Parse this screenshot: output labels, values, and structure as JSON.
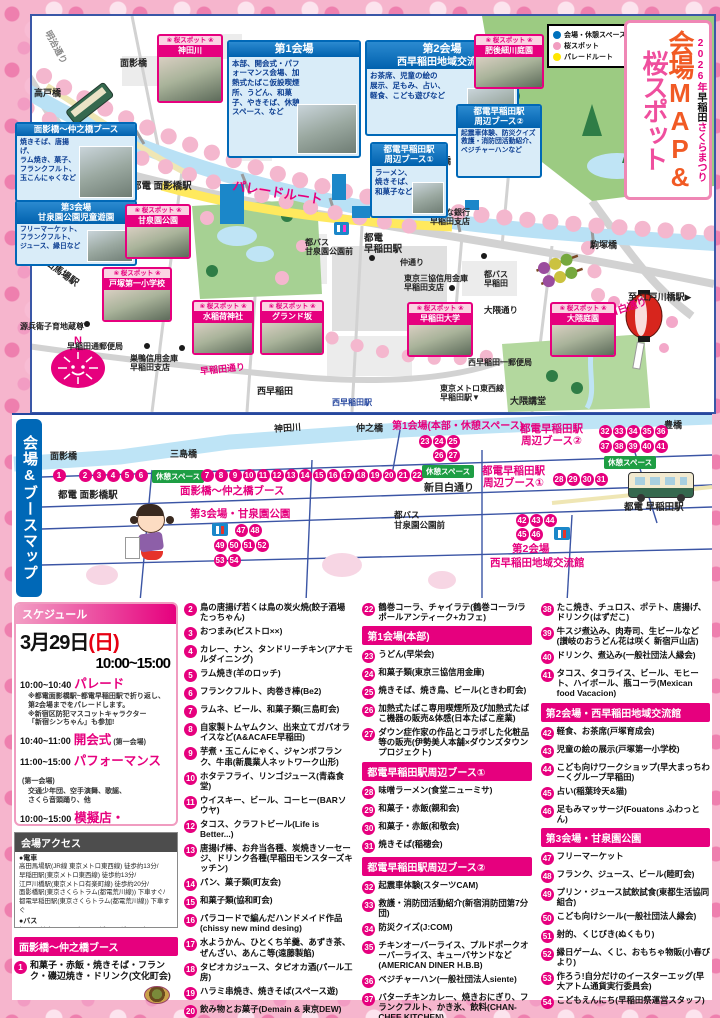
{
  "poster": {
    "title_sub_year": "2026年",
    "title_sub_mid": "早稲田",
    "title_sub_end": "さくらまつり",
    "title_main_1": "会場MAP&",
    "title_main_2": "桜スポット"
  },
  "colors": {
    "accent": "#e6007e",
    "venue_blue": "#0071bc",
    "sakura_pink": "#f19dc0",
    "parade_yellow": "#ffe600",
    "river": "#b9e1f5",
    "orange_title": "#f15a24"
  },
  "legend": {
    "items": [
      {
        "label": "会場・休憩スペース",
        "color": "#0071bc"
      },
      {
        "label": "桜スポット",
        "color": "#f19dc0"
      },
      {
        "label": "パレードルート",
        "color": "#ffe600"
      }
    ]
  },
  "map": {
    "labels": {
      "meiji_dori": "明治通り",
      "takato_bashi": "高戸橋",
      "omokage_bashi": "面影橋",
      "mishima_bashi": "三島橋",
      "nakano_bashi": "仲之橋",
      "toyo_bashi": "豊橋",
      "komatsuka_bashi": "駒塚橋",
      "toden_omokage_sta": "都電 面影橋駅",
      "parade_route": "パレードルート",
      "tobus_sensenen": "都バス\n甘泉園公園前",
      "toden_waseda_sta": "都電\n早稲田駅",
      "risona": "りそな銀行\n早稲田支店",
      "naka_dori": "仲通り",
      "sankyo_bank": "東京三協信用金庫\n早稲田支店",
      "nishiwaseda": "西早稲田",
      "nishiwaseda_sta": "西早稲田駅",
      "metro_waseda": "東京メトロ東西線\n早稲田駅▼",
      "okuma_dori": "大隈通り",
      "tobus_waseda": "都バス\n早稲田",
      "nishiwaseda_post": "西早稲田一郵便局",
      "okuma_auditorium": "大隈講堂",
      "edogawabashi": "至 江戸川橋駅▶",
      "shinmejiro_dori": "新目白通り",
      "takadanobaba": "◀至 高田馬場駅",
      "genbei_jizo": "源兵衛子育地蔵尊",
      "waseda_post": "早稲田通郵便局",
      "sugamo_bank": "巣鴨信用金庫\n早稲田支店",
      "waseda_dori": "早稲田通り"
    },
    "venues": [
      {
        "title": "第1会場",
        "body": "本部、開会式・パフォーマンス会場、加熱式たばこ仮設喫煙所、うどん、和菓子、やきそば、休憩スペース、など"
      },
      {
        "title": "第2会場",
        "title2": "西早稲田地域交流館",
        "body": "お茶席、児童の絵の\n展示、足もみ、占い、\n軽食、こども遊びなど"
      },
      {
        "title": "都電早稲田駅\n周辺ブース①",
        "body": "ラーメン、\n焼きそば、\n和菓子など"
      },
      {
        "title": "都電早稲田駅\n周辺ブース②",
        "body": "起震車体験、防災クイズ\n救護・消防団活動紹介、\nベジチャーハンなど"
      },
      {
        "title": "面影橋〜仲之橋ブース",
        "body": "焼きそば、唐揚げ、\nラム焼き、菓子、\nフランクフルト、\n玉こんにゃくなど"
      },
      {
        "title": "第3会場",
        "title2": "甘泉園公園児童遊園",
        "body": "フリーマーケット、\nフランクフルト、\nジュース、縁日など"
      }
    ],
    "spot_tag": "❀ 桜スポット ❀",
    "spots": [
      {
        "name": "神田川"
      },
      {
        "name": "肥後細川庭園"
      },
      {
        "name": "甘泉園公園"
      },
      {
        "name": "戸塚第一小学校"
      },
      {
        "name": "水稲荷神社"
      },
      {
        "name": "グランド坂"
      },
      {
        "name": "早稲田大学"
      },
      {
        "name": "大隈庭園"
      }
    ]
  },
  "booth_map": {
    "bar_label": "会場&ブースマップ",
    "labels": {
      "kandagawa": "神田川",
      "omokage": "面影橋",
      "mishima": "三島橋",
      "nakano": "仲之橋",
      "toyo": "豊橋",
      "toden_omokage": "都電 面影橋駅",
      "omokage_booth": "面影橋〜仲之橋ブース",
      "v3": "第3会場・甘泉園公園",
      "v1": "第1会場(本部・休憩スペース)",
      "b2": "都電早稲田駅\n周辺ブース②",
      "b1": "都電早稲田駅\n周辺ブース①",
      "shinmejiro": "新目白通り",
      "tobus": "都バス\n甘泉園公園前",
      "toden_waseda": "都電 早稲田駅",
      "v2a": "第2会場",
      "v2b": "西早稲田地域交流館",
      "rest": "休憩スペース"
    },
    "c1": [
      1
    ],
    "c2": [
      2,
      3,
      4,
      5,
      6
    ],
    "c3": [
      7,
      8,
      9,
      10,
      11,
      12,
      13,
      14,
      15,
      16,
      17,
      18,
      19,
      20,
      21,
      22
    ],
    "c4a": [
      23,
      24,
      25
    ],
    "c4b": [
      26,
      27
    ],
    "c5a": [
      32,
      33,
      34,
      35,
      36
    ],
    "c5b": [
      37,
      38,
      39,
      40,
      41
    ],
    "c6": [
      28,
      29,
      30,
      31
    ],
    "c7a": [
      42,
      43,
      44
    ],
    "c7b": [
      45,
      46
    ],
    "c8a": [
      47,
      48
    ],
    "c8b": [
      49,
      50,
      51,
      52
    ],
    "c8c": [
      53,
      54
    ]
  },
  "schedule": {
    "header": "スケジュール",
    "date": "3月29日",
    "date_sub": "(日)",
    "time": "10:00~15:00",
    "events": [
      {
        "time": "10:00~10:40",
        "name": "パレード",
        "sub": "",
        "notes": "※都電面影橋駅~都電早稲田駅で折り返し、\n第2会場までをパレードします。\n※新宿区防犯マスコットキャラクター\n「新宿シンちゃん」も参加!"
      },
      {
        "time": "10:40~11:00",
        "name": "開会式",
        "sub": "(第一会場)",
        "notes": ""
      },
      {
        "time": "11:00~15:00",
        "name": "パフォーマンス",
        "sub": "(第一会場)",
        "notes": "交通少年団、空手演舞、歌謡、\nさくら音頭踊り、他"
      },
      {
        "time": "10:00~15:00",
        "name": "模擬店・\nフリーマーケット",
        "sub": "※売り切れ御免",
        "notes": ""
      }
    ]
  },
  "access": {
    "header": "会場アクセス",
    "train_label": "●電車",
    "train": "高田馬場駅(JR線 東京メトロ東西線) 徒歩約13分/\n早稲田駅(東京メトロ東西線) 徒歩約13分/\n江戸川橋駅(東京メトロ有楽町線) 徒歩約20分/\n面影橋駅(東京さくらトラム(都電荒川線)) 下車すぐ/\n都電早稲田駅(東京さくらトラム(都電荒川線)) 下車すぐ",
    "bus_label": "●バス",
    "bus": "都バス 甘泉園公園/グランド坂下/早稲田 下車すぐ",
    "notes": "※ご来場は交通機関をご利用ください。\n※駐輪場はありません。"
  },
  "booth_list": {
    "col1_header": "面影橋〜仲之橋ブース",
    "col1_item": {
      "n": "1",
      "text": "和菓子・赤飯・焼きそば・フランク・磯辺焼き・ドリンク(文化町会)"
    },
    "flow": [
      {
        "n": "2",
        "text": "鳥の唐揚げ若くは鳥の炭火焼(餃子酒場たっちゃん)"
      },
      {
        "n": "3",
        "text": "おつまみ(ビストロ××)"
      },
      {
        "n": "4",
        "text": "カレー、ナン、タンドリーチキン(アナモルダイニング)"
      },
      {
        "n": "5",
        "text": "ラム焼き(羊のロッチ)"
      },
      {
        "n": "6",
        "text": "フランクフルト、肉巻き棒(Be2)"
      },
      {
        "n": "7",
        "text": "ラムネ、ビール、和菓子類(三島町会)"
      },
      {
        "n": "8",
        "text": "自家製トムヤムクン、出来立てガパオライスなど(A&ACAFE早稲田)"
      },
      {
        "n": "9",
        "text": "芋煮・玉こんにゃく、ジャンボフランク、牛串(新農業人ネットワーク山形)"
      },
      {
        "n": "10",
        "text": "ホタテフライ、リンゴジュース(青森食堂)"
      },
      {
        "n": "11",
        "text": "ウイスキー、ビール、コーヒー(BARソウヤ)"
      },
      {
        "n": "12",
        "text": "タコス、クラフトビール(Life is Better...)"
      },
      {
        "n": "13",
        "text": "唐揚げ棒、お弁当各種、炭焼きソーセージ、ドリンク各種(早稲田モンスターズキッチン)"
      },
      {
        "n": "14",
        "text": "パン、菓子類(町友会)"
      },
      {
        "n": "15",
        "text": "和菓子類(協和町会)"
      },
      {
        "n": "16",
        "text": "パラコードで編んだハンドメイド作品(chissy new mind desing)"
      },
      {
        "n": "17",
        "text": "水ようかん、ひとくち羊羹、あずき茶、ぜんざい、あんこ等(遠藤製餡)"
      },
      {
        "n": "18",
        "text": "タピオカジュース、タピオカ酒(パール工房)"
      },
      {
        "n": "19",
        "text": "ハラミ串焼き、焼きそば(スペース遊)"
      },
      {
        "n": "20",
        "text": "飲み物とお菓子(Demain & 東京DEW)"
      },
      {
        "n": "21",
        "text": "ひとくちバスクチーズケーキ(さかなやしんせい)"
      },
      {
        "n": "22",
        "text": "鶴巻コーラ、チャイラテ(鶴巻コーラ/ラポールアンティーク+カフェ)"
      },
      {
        "header": "第1会場(本部)"
      },
      {
        "n": "23",
        "text": "うどん(早栄会)"
      },
      {
        "n": "24",
        "text": "和菓子類(東京三協信用金庫)"
      },
      {
        "n": "25",
        "text": "焼きそば、焼き鳥、ビール(ときわ町会)"
      },
      {
        "n": "26",
        "text": "加熱式たばこ専用喫煙所及び加熱式たばこ機器の販売&体感(日本たばこ産業)"
      },
      {
        "n": "27",
        "text": "ダウン症作家の作品とコラボした化粧品等の販売(伊勢美人本舗×ダウンズタウンプロジェクト)"
      },
      {
        "header": "都電早稲田駅周辺ブース①"
      },
      {
        "n": "28",
        "text": "味噌ラーメン(食堂ニューミサ)"
      },
      {
        "n": "29",
        "text": "和菓子・赤飯(親和会)"
      },
      {
        "n": "30",
        "text": "和菓子・赤飯(和敬会)"
      },
      {
        "n": "31",
        "text": "焼きそば(稲穂会)"
      },
      {
        "header": "都電早稲田駅周辺ブース②"
      },
      {
        "n": "32",
        "text": "起震車体験(スターツCAM)"
      },
      {
        "n": "33",
        "text": "救護・消防団活動紹介(新宿消防団第7分団)"
      },
      {
        "n": "34",
        "text": "防災クイズ(J:COM)"
      },
      {
        "n": "35",
        "text": "チキンオーバーライス、プルドポークオーバーライス、キューバサンドなど(AMERICAN DINER H.B.B)"
      },
      {
        "n": "36",
        "text": "ベジチャーハン(一般社団法人siente)"
      },
      {
        "n": "37",
        "text": "バターチキンカレー、焼きおにぎり、フランクフルト、かき氷、飲料(CHAN-CHEE KITCHEN)"
      },
      {
        "n": "38",
        "text": "たこ焼き、チュロス、ポテト、唐揚げ、ドリンク(はずだこ)"
      },
      {
        "n": "39",
        "text": "牛スジ煮込み、肉寿司、生ビールなど(讃岐のおうどん花は咲く 新宿戸山店)"
      },
      {
        "n": "40",
        "text": "ドリンク、煮込み(一般社団法人縁会)"
      },
      {
        "n": "41",
        "text": "タコス、タコライス、ビール、モヒート、ハイボール、瓶コーラ(Mexican food Vacacion)"
      },
      {
        "header": "第2会場・西早稲田地域交流館"
      },
      {
        "n": "42",
        "text": "軽食、お茶席(戸塚育成会)"
      },
      {
        "n": "43",
        "text": "児童の絵の展示(戸塚第一小学校)"
      },
      {
        "n": "44",
        "text": "こども向けワークショップ(早大まっちわーくグループ早稲田)"
      },
      {
        "n": "45",
        "text": "占い(稲葉玲天&猫)"
      },
      {
        "n": "46",
        "text": "足もみマッサージ(Fouatons ふわっとん)"
      },
      {
        "header": "第3会場・甘泉園公園"
      },
      {
        "n": "47",
        "text": "フリーマーケット"
      },
      {
        "n": "48",
        "text": "フランク、ジュース、ビール(睦町会)"
      },
      {
        "n": "49",
        "text": "プリン・ジュース試飲試食(東都生活協同組合)"
      },
      {
        "n": "50",
        "text": "こども向けシール(一般社団法人縁会)"
      },
      {
        "n": "51",
        "text": "射的、くじびき(ぬくもり)"
      },
      {
        "n": "52",
        "text": "縁日ゲーム、くじ、おもちゃ物販(小春びより)"
      },
      {
        "n": "53",
        "text": "作ろう!自分だけのイースターエッグ(早大アトム通貨実行委員会)"
      },
      {
        "n": "54",
        "text": "こどもえんにち(早稲田祭運営スタッフ)"
      }
    ]
  }
}
